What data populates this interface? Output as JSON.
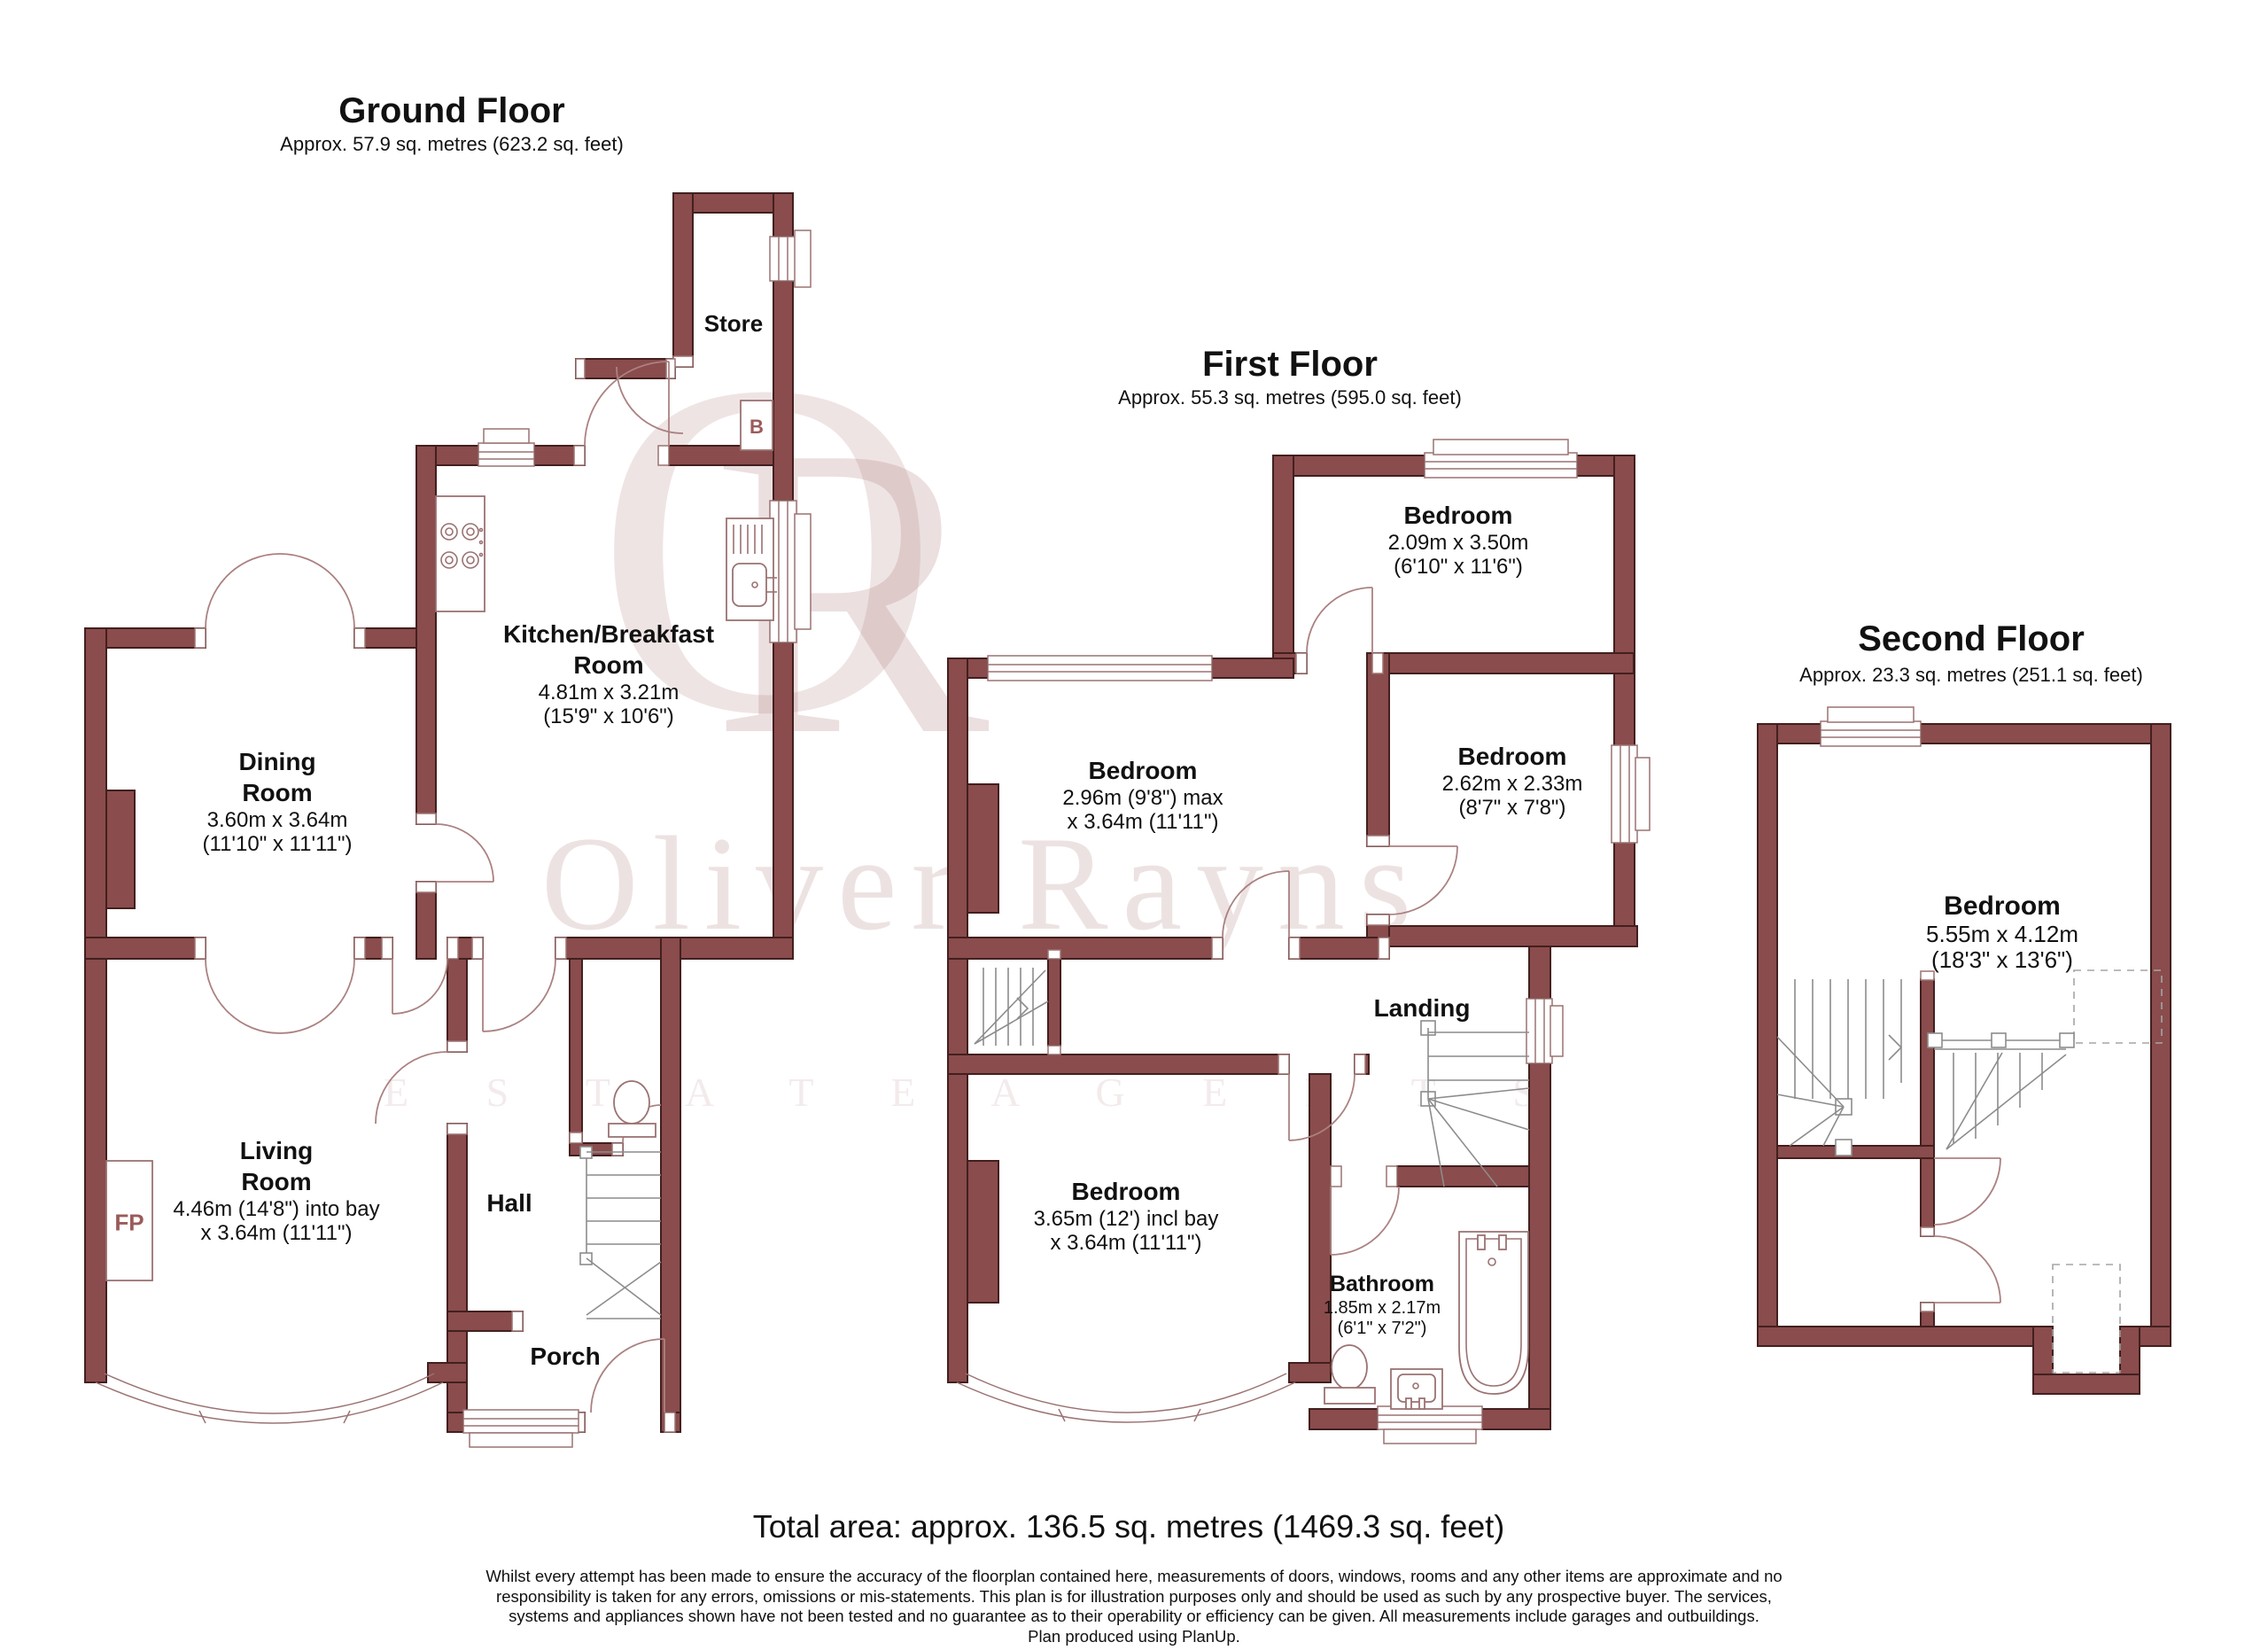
{
  "watermark": {
    "monogram_o": "O",
    "monogram_r": "R",
    "brand": "Oliver Rayns",
    "tagline": "E S T A T E   A G E N T S",
    "color": "#a87a7a"
  },
  "floors": [
    {
      "title": "Ground Floor",
      "area": "Approx. 57.9 sq. metres (623.2 sq. feet)",
      "rooms": {
        "store": {
          "name": "Store"
        },
        "kitchen": {
          "name": "Kitchen/Breakfast\nRoom",
          "dim1": "4.81m x 3.21m",
          "dim2": "(15'9\" x 10'6\")"
        },
        "dining": {
          "name": "Dining\nRoom",
          "dim1": "3.60m x 3.64m",
          "dim2": "(11'10\" x 11'11\")"
        },
        "living": {
          "name": "Living\nRoom",
          "dim1": "4.46m (14'8\") into bay",
          "dim2": "x 3.64m (11'11\")"
        },
        "hall": {
          "name": "Hall"
        },
        "porch": {
          "name": "Porch"
        }
      },
      "markers": {
        "fireplace": "FP",
        "boiler": "B"
      }
    },
    {
      "title": "First Floor",
      "area": "Approx. 55.3 sq. metres (595.0 sq. feet)",
      "rooms": {
        "bed_top": {
          "name": "Bedroom",
          "dim1": "2.09m x 3.50m",
          "dim2": "(6'10\" x 11'6\")"
        },
        "bed_mid": {
          "name": "Bedroom",
          "dim1": "2.96m (9'8\") max",
          "dim2": "x 3.64m (11'11\")"
        },
        "bed_right": {
          "name": "Bedroom",
          "dim1": "2.62m x 2.33m",
          "dim2": "(8'7\" x 7'8\")"
        },
        "landing": {
          "name": "Landing"
        },
        "bed_bottom": {
          "name": "Bedroom",
          "dim1": "3.65m (12') incl bay",
          "dim2": "x 3.64m (11'11\")"
        },
        "bathroom": {
          "name": "Bathroom",
          "dim1": "1.85m x 2.17m",
          "dim2": "(6'1\" x 7'2\")"
        }
      }
    },
    {
      "title": "Second Floor",
      "area": "Approx. 23.3 sq. metres (251.1 sq. feet)",
      "rooms": {
        "bedroom": {
          "name": "Bedroom",
          "dim1": "5.55m x 4.12m",
          "dim2": "(18'3\" x 13'6\")"
        }
      }
    }
  ],
  "footer": {
    "total": "Total area: approx. 136.5 sq. metres (1469.3 sq. feet)",
    "disclaimer_lines": [
      "Whilst every attempt has been made to ensure the accuracy of the floorplan contained here, measurements of doors, windows, rooms and any other items are approximate and no",
      "responsibility is taken for any errors, omissions or mis-statements.  This plan is for illustration purposes only and should be used as such by any prospective buyer. The services,",
      "systems and appliances shown have not been tested and no guarantee as to their operability or efficiency can be given. All measurements include garages and outbuildings.",
      "Plan produced using PlanUp."
    ]
  }
}
